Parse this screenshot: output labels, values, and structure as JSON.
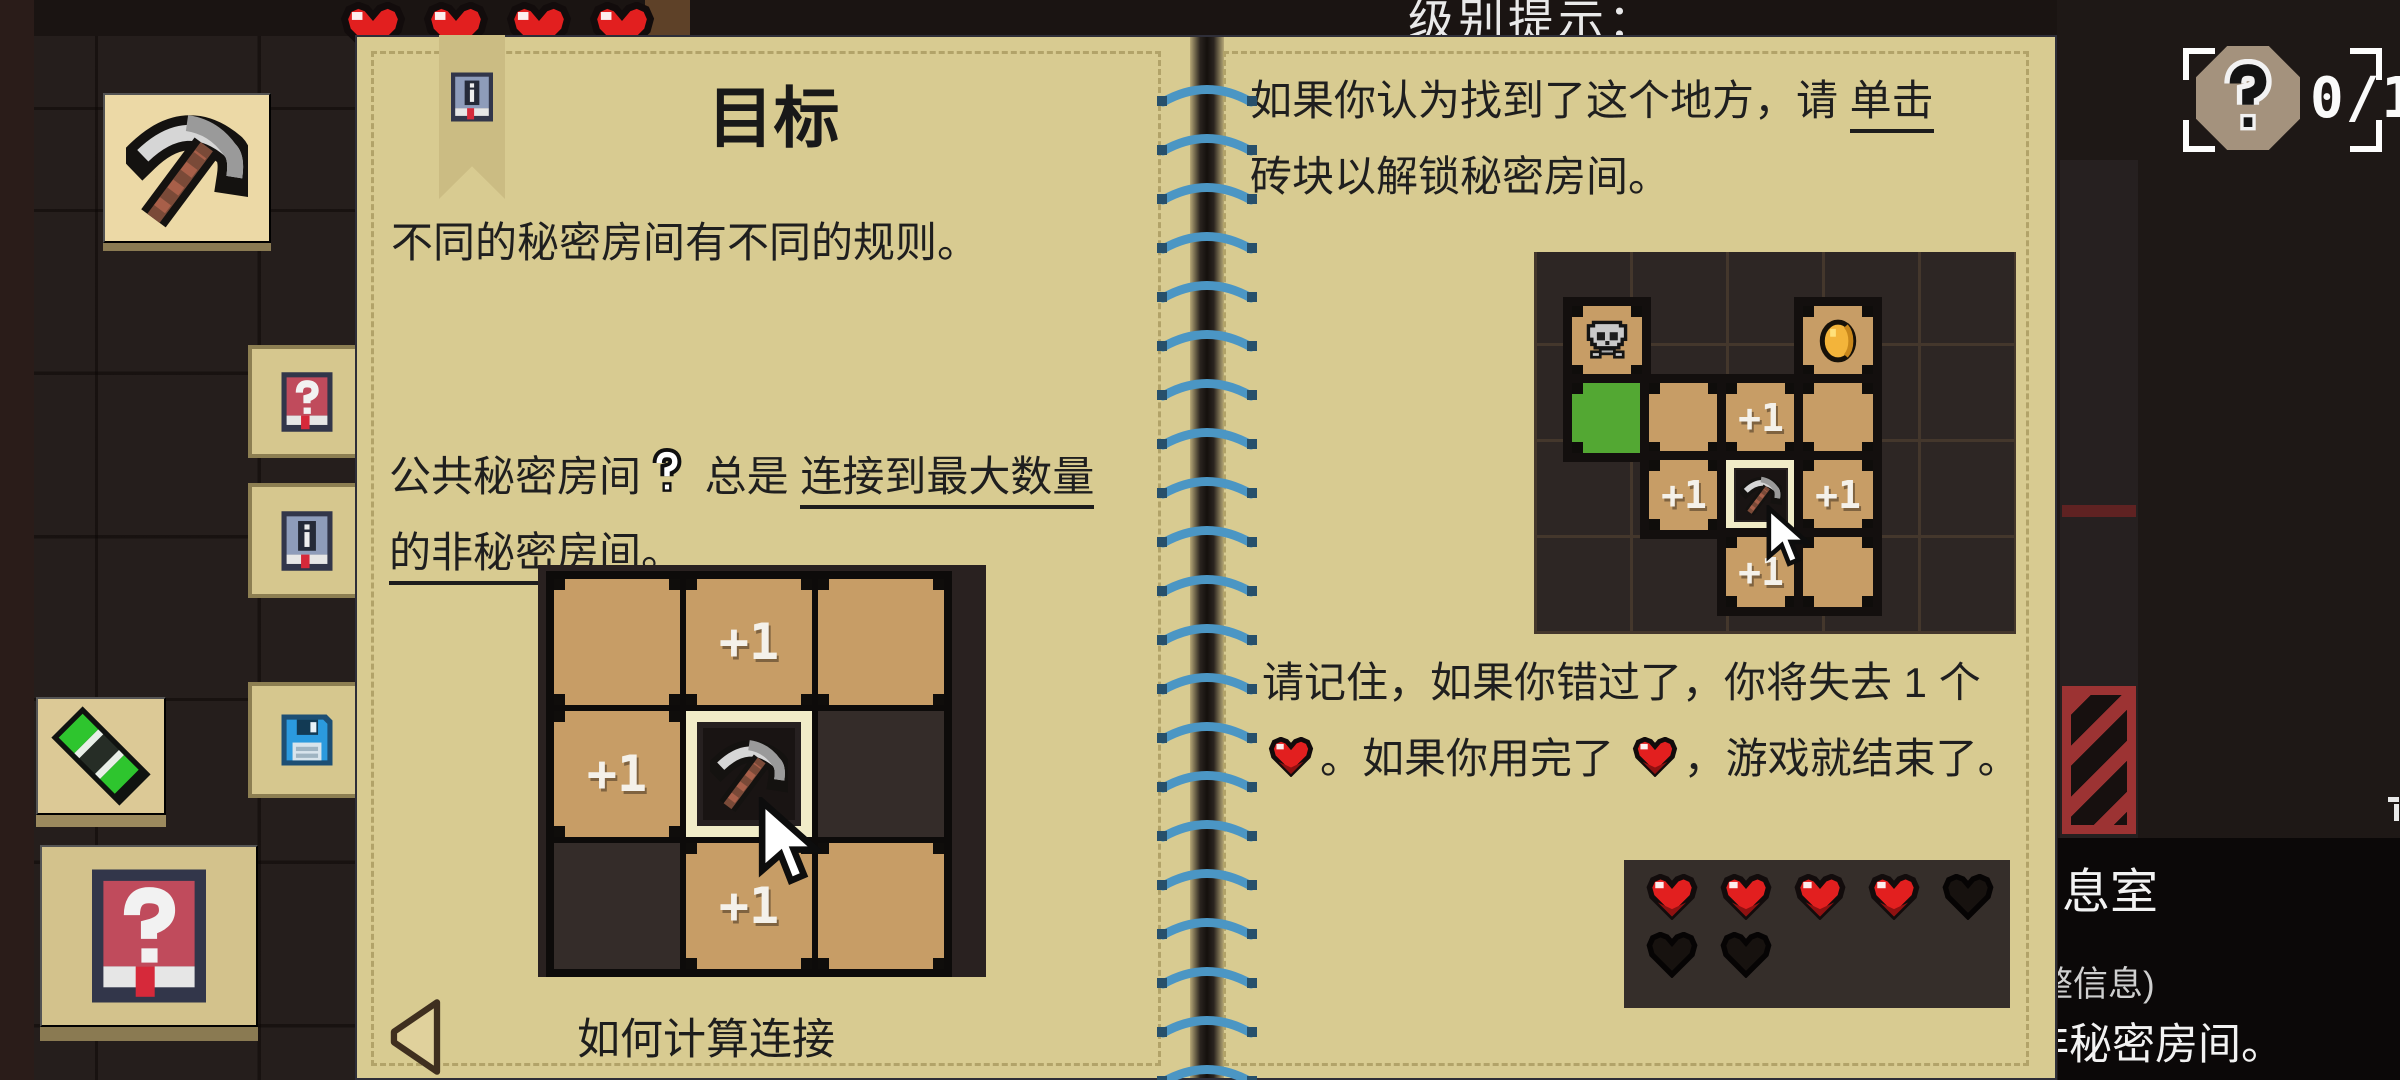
{
  "hud": {
    "level_hint": "级别提示：",
    "counter": {
      "value": "0/1",
      "icon": "question-mark-badge"
    },
    "hearts_top_count": 4,
    "tooltip": {
      "line1": "息室",
      "line2": "整信息)",
      "line3": "非秘密房间。"
    }
  },
  "sidebar": {
    "pickaxe_button_icon": "pickaxe-icon",
    "marker_button_icon": "green-marker-icon",
    "help_button_icon": "red-question-book-icon"
  },
  "tabs": [
    {
      "name": "help-tab",
      "icon": "red-question-book-icon"
    },
    {
      "name": "info-tab",
      "icon": "blue-info-book-icon"
    },
    {
      "name": "save-tab",
      "icon": "floppy-disk-icon"
    }
  ],
  "book": {
    "binding": {
      "stitch_count": 21
    },
    "bookmark_icon": "blue-info-book-icon",
    "left_page": {
      "title": "目标",
      "para1": "不同的秘密房间有不同的规则。",
      "para2_pre": "公共秘密房间",
      "para2_icon": "question-mark-icon",
      "para2_mid": " 总是 ",
      "para2_underline1": "连接到最大数量",
      "para2_underline2": "的非秘密房间。",
      "caption": "如何计算连接",
      "prev_button": "prev-page-arrow",
      "grid": {
        "plus_one": "+1",
        "rows": [
          [
            "tan",
            "tan+1",
            "tan"
          ],
          [
            "tan+1",
            "pick",
            "dark"
          ],
          [
            "dark",
            "tan+1",
            "tan"
          ]
        ]
      }
    },
    "right_page": {
      "para1_pre": "如果你认为找到了这个地方，请 ",
      "para1_underline": "单击",
      "para1_post": "砖块以解锁秘密房间。",
      "para2_part1": "请记住，如果你错过了，你将失去 1 个",
      "para2_part2": "。如果你用完了 ",
      "para2_part3": "，游戏就结束了。",
      "grid": {
        "plus_one": "+1",
        "rows": [
          [
            "skull",
            "none",
            "none",
            "coin"
          ],
          [
            "green",
            "tan",
            "tan+1",
            "tan"
          ],
          [
            "none",
            "tan+1",
            "pick",
            "tan+1"
          ],
          [
            "none",
            "none",
            "tan+1",
            "tan"
          ]
        ]
      },
      "hearts": {
        "full": 4,
        "empty": 3,
        "per_row": 5
      }
    }
  },
  "colors": {
    "page_tan": "#d8cb91",
    "tile_tan": "#c79d66",
    "tile_green": "#53a833",
    "highlight_cream": "#f1ecc8",
    "stitch_blue": "#4b96c4",
    "heart_red": "#e21f1f",
    "trap_red": "#9c3333",
    "bg_dark": "#251e1c"
  }
}
